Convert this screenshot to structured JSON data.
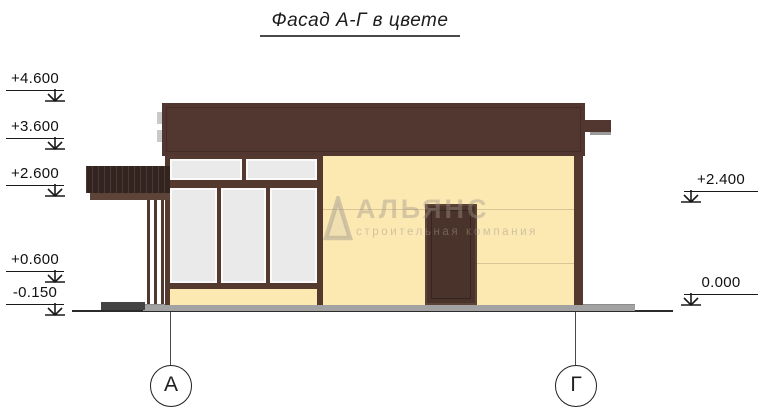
{
  "title": "Фасад А-Г в цвете",
  "elevation_markers": {
    "left": [
      {
        "value": "+4.600"
      },
      {
        "value": "+3.600"
      },
      {
        "value": "+2.600"
      },
      {
        "value": "+0.600"
      },
      {
        "value": "-0.150"
      }
    ],
    "right": [
      {
        "value": "+2.400"
      },
      {
        "value": "0.000"
      }
    ]
  },
  "axis_bubbles": [
    {
      "label": "А"
    },
    {
      "label": "Г"
    }
  ],
  "watermark": {
    "name": "АЛЬЯНС",
    "tagline": "строительная компания"
  },
  "colors": {
    "roof_brown": "#523730",
    "frame_brown": "#53392e",
    "door_brown": "#4a332b",
    "awning_dark": "#33241f",
    "canopy_fascia_brown": "#5d4338",
    "wall_cream": "#fce9b2",
    "window_glass": "#eaeaea",
    "base_gray": "#a2a2a2",
    "platform_gray": "#434343",
    "drawing_line": "#1a1a1a"
  }
}
